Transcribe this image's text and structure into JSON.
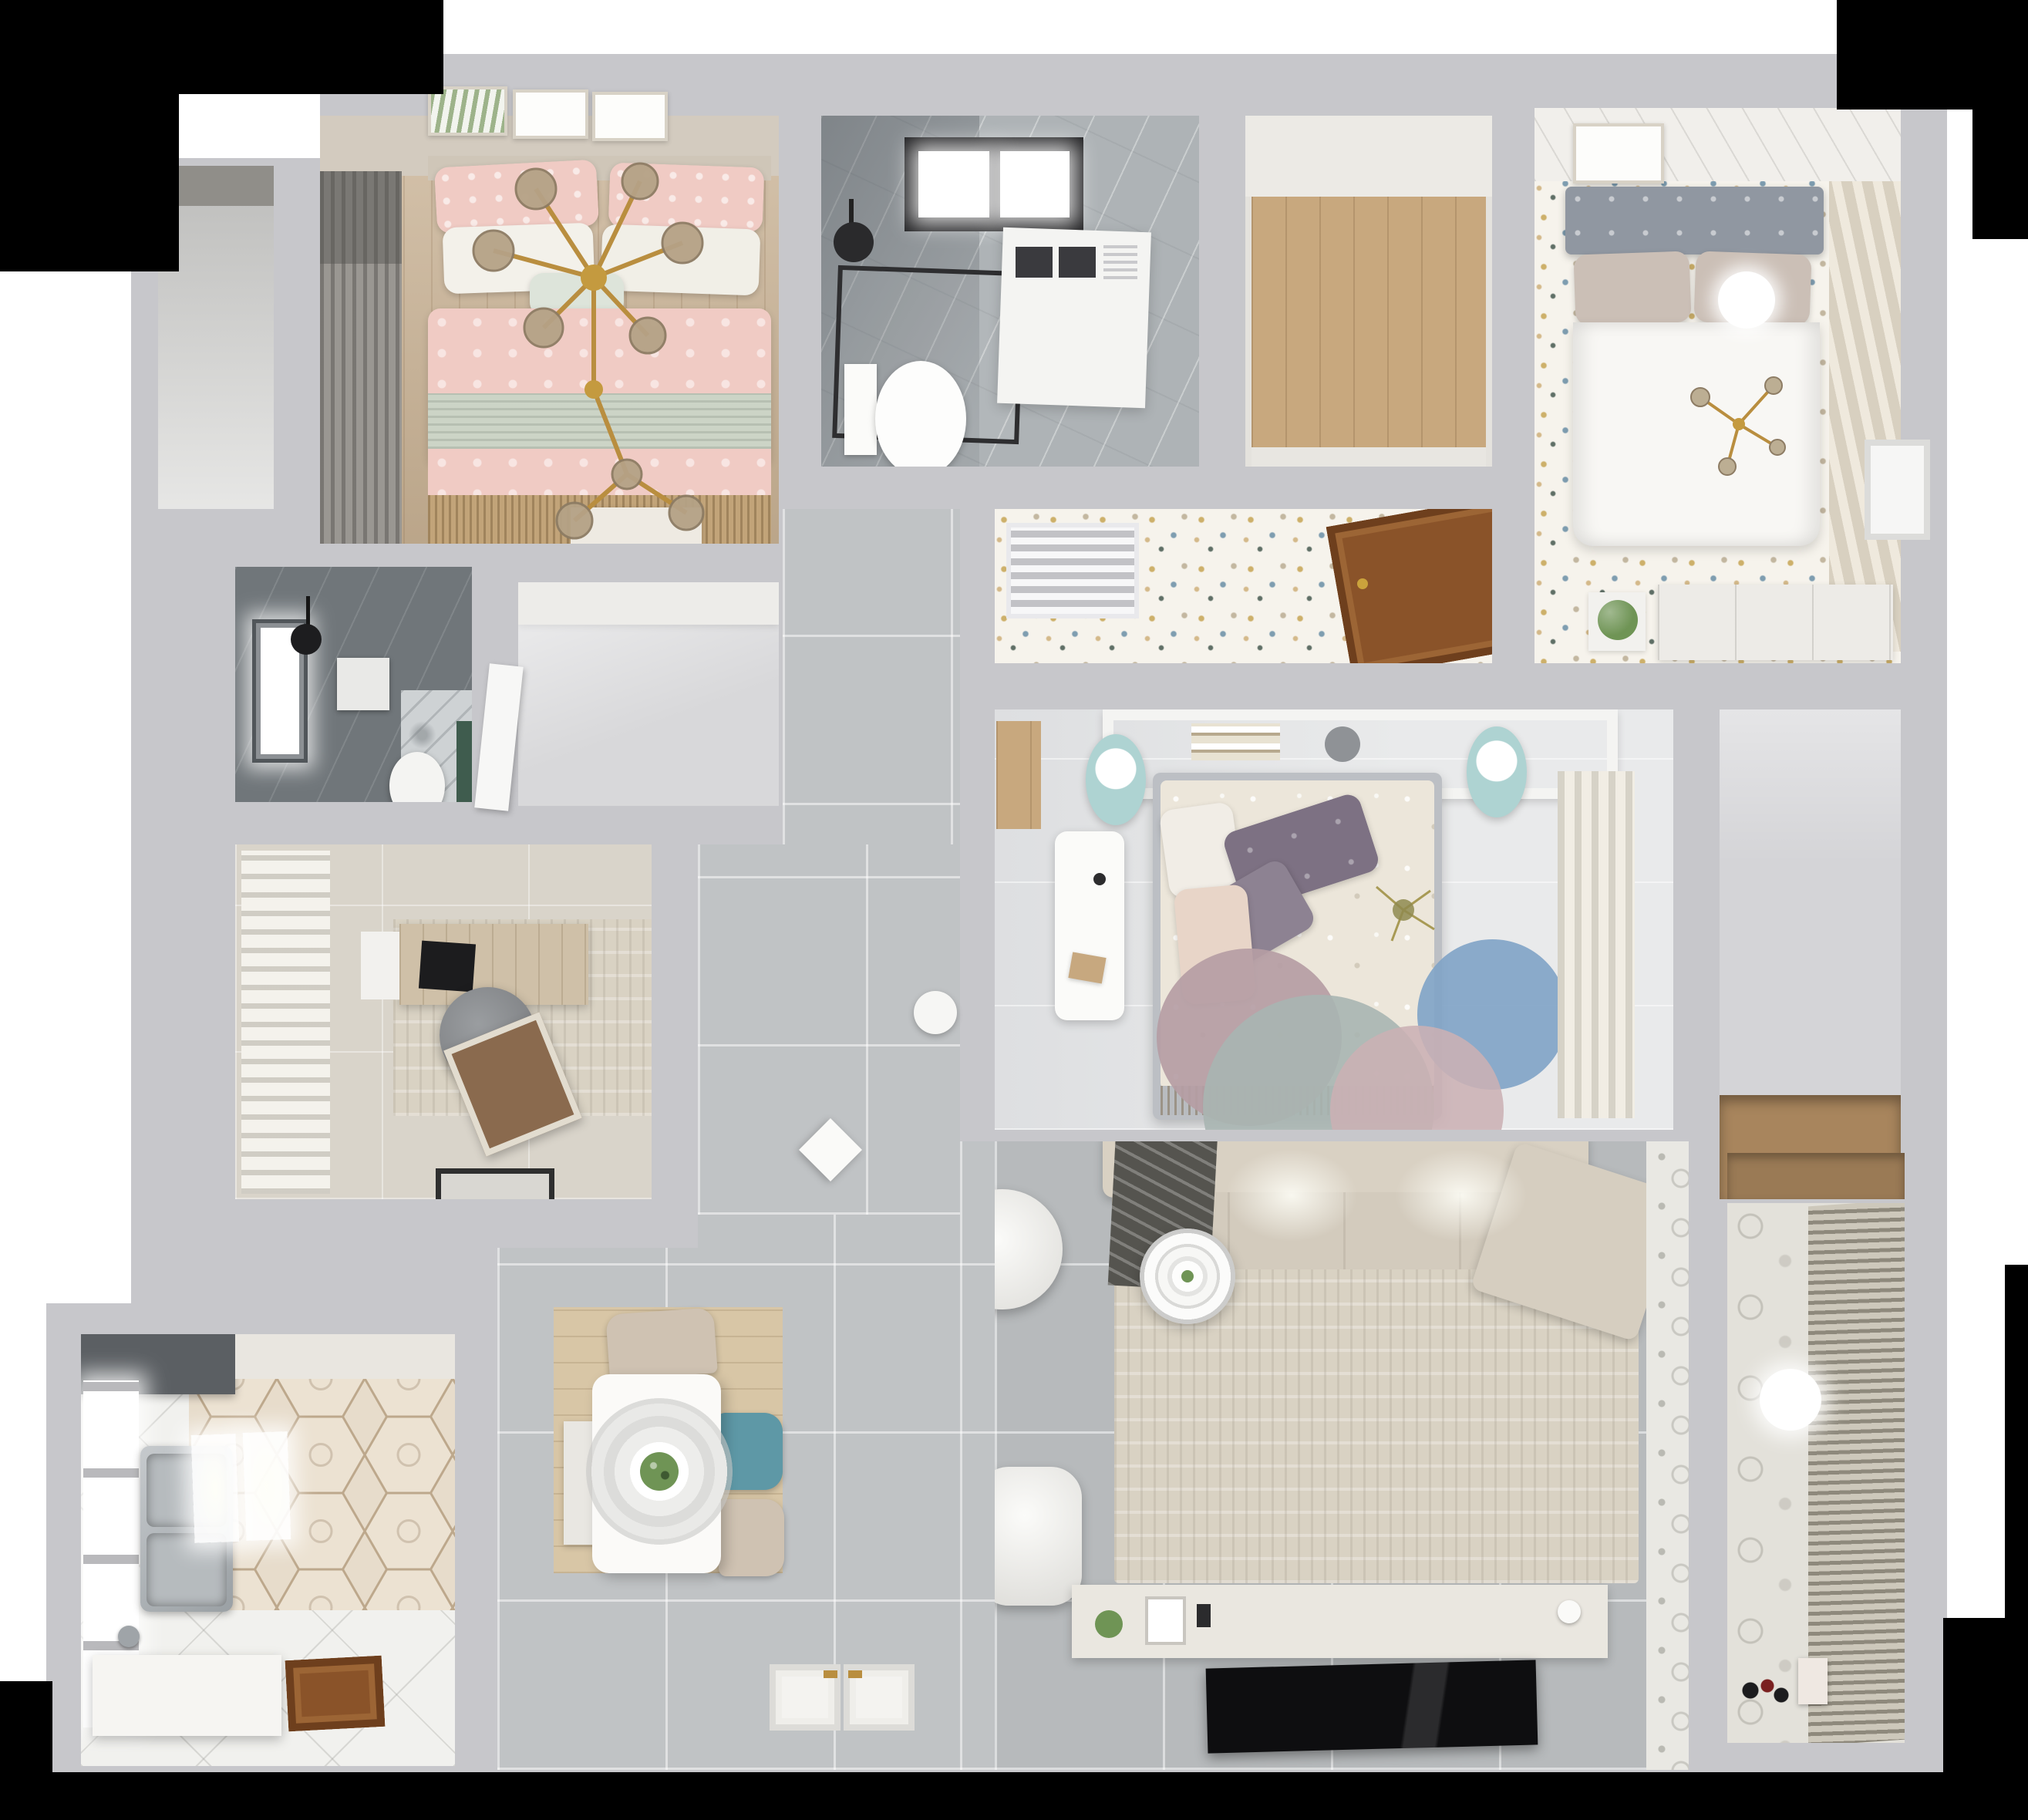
{
  "scene": {
    "title": "Top-down 3D render of a furnished apartment floor plan",
    "view": "overhead dollhouse perspective",
    "background": "white with black cropped corners"
  },
  "palette": {
    "backdrop_black": "#000000",
    "wall": "#c7c7cb",
    "wood_floor": "#c9b294",
    "wood_plank": "#c8a87e",
    "terrazzo": "#f6f3ec",
    "marble_bath": "#aeb3b6",
    "dark_bath": "#70767a",
    "study_floor": "#d9d4ca",
    "bedroom3_floor": "#e9eaeb",
    "tile_hall": "#c0c3c5",
    "tile_living": "#b7babc",
    "tile_kitchen": "#f1f1ee",
    "nook_floor": "#d4d4d7",
    "balcony_floor": "#dcdcda",
    "pink_duvet": "#f0cbc4",
    "sage_band": "#ccd4c6",
    "white_duvet": "#f8f7f4",
    "headboard_gray": "#9097a1",
    "floral_duvet": "#ece6da",
    "pillow_purple": "#7d7183",
    "pillow_blush": "#e8d5c8",
    "sofa_beige": "#d9d1c3",
    "rug_beige": "#d9d2c3",
    "rug_mauve": "#b59da4",
    "rug_tealgray": "#a9b5b1",
    "rug_blue": "#7fa3c6",
    "rug_pink": "#cbb0b4",
    "pouf_teal": "#aed3d2",
    "teal_chair": "#5e98a6",
    "beige_chair": "#cfc2b2",
    "mat_wood": "#d8c6a6",
    "wood_door": "#8a5329",
    "tv_black": "#0e0e10",
    "plant_green": "#6f9455",
    "gold": "#b98e3f",
    "hex_tile": "#e7dccb",
    "balcony_pattern": "#e3e1da",
    "hood_gray": "#5b5f63"
  },
  "rooms": [
    {
      "id": "bedroom-blush",
      "label": "Blush bedroom with double bed, gold branch chandelier, wall art and gray drapes",
      "furniture": [
        "double-bed",
        "pink-pillows",
        "white-pillows",
        "sage-throw",
        "gold-branch-chandelier",
        "wall-art-frames",
        "curtains"
      ]
    },
    {
      "id": "main-bathroom",
      "label": "Bathroom with black-framed skylight, shower enclosure, washing machine and toilet",
      "furniture": [
        "skylight-window",
        "shower-enclosure",
        "shower-head",
        "washing-machine",
        "toilet"
      ]
    },
    {
      "id": "storage-room",
      "label": "Storage room with plank wood floor",
      "furniture": []
    },
    {
      "id": "bedroom-white",
      "label": "White bedroom with gray tufted headboard, paper lantern and striped wardrobe curtain",
      "furniture": [
        "double-bed",
        "tufted-headboard",
        "paper-lantern",
        "gold-sprig",
        "dresser",
        "plant",
        "striped-curtain",
        "wall-art-frame"
      ]
    },
    {
      "id": "terrazzo-corridor",
      "label": "Corridor with terrazzo floor, AC grille and open wooden door",
      "furniture": [
        "ac-vent-grille",
        "wood-door"
      ]
    },
    {
      "id": "ensuite-bathroom",
      "label": "Dark tiled en-suite bathroom with window, shower head and toilet",
      "furniture": [
        "window",
        "shower-head",
        "toilet",
        "marble-panel",
        "green-accent"
      ]
    },
    {
      "id": "dressing-nook",
      "label": "Dressing nook with wardrobe band and open white door",
      "furniture": [
        "wardrobe",
        "white-door"
      ]
    },
    {
      "id": "study",
      "label": "Study with billowing curtains, desk, round chair, lounge chair, rug and doormat",
      "furniture": [
        "desk",
        "monitor",
        "office-chair",
        "lounge-chair",
        "area-rug",
        "doormat",
        "curtains"
      ]
    },
    {
      "id": "bedroom-center",
      "label": "Center bedroom with floral bed, purple pillows, headboard shelf, poufs, desk and overlapping round rugs",
      "furniture": [
        "double-bed",
        "headboard-shelf",
        "books",
        "bowl",
        "pouf",
        "pouf",
        "desk",
        "stool",
        "round-rugs",
        "curtains",
        "wood-niche"
      ]
    },
    {
      "id": "hallway-dining",
      "label": "Gray tiled hallway and dining area with table, pendant lamp and chairs",
      "furniture": [
        "dining-table",
        "pendant-lamp",
        "dining-chairs",
        "wood-mat",
        "entry-double-door",
        "side-table",
        "waste-bin"
      ]
    },
    {
      "id": "kitchen",
      "label": "Kitchen with hexagon tile, range hood, double sink, counters and wooden door",
      "furniture": [
        "range-hood",
        "double-sink",
        "counter",
        "faucet",
        "windows",
        "wood-door",
        "ceiling-lights"
      ]
    },
    {
      "id": "living-room",
      "label": "Living room with beige sectional sofa, large rug, ring coffee table, armchairs, TV console and TV",
      "furniture": [
        "sectional-sofa",
        "throw-blanket",
        "area-rug",
        "coffee-table",
        "armchair",
        "armchair-ottoman",
        "tv-console",
        "tv-panel",
        "decor-items"
      ]
    },
    {
      "id": "balcony-laundry",
      "label": "Balcony with patterned tile wall, louvered blinds, globe lamp and toys",
      "furniture": [
        "louvered-blinds",
        "globe-lamp",
        "toys",
        "paper-bag"
      ]
    },
    {
      "id": "utility-nook",
      "label": "Utility nook with wood shelf and white wall door",
      "furniture": [
        "wood-shelf",
        "white-door"
      ]
    },
    {
      "id": "side-balcony",
      "label": "Narrow side balcony behind bedroom drapes",
      "furniture": [
        "roller-shade"
      ]
    }
  ]
}
